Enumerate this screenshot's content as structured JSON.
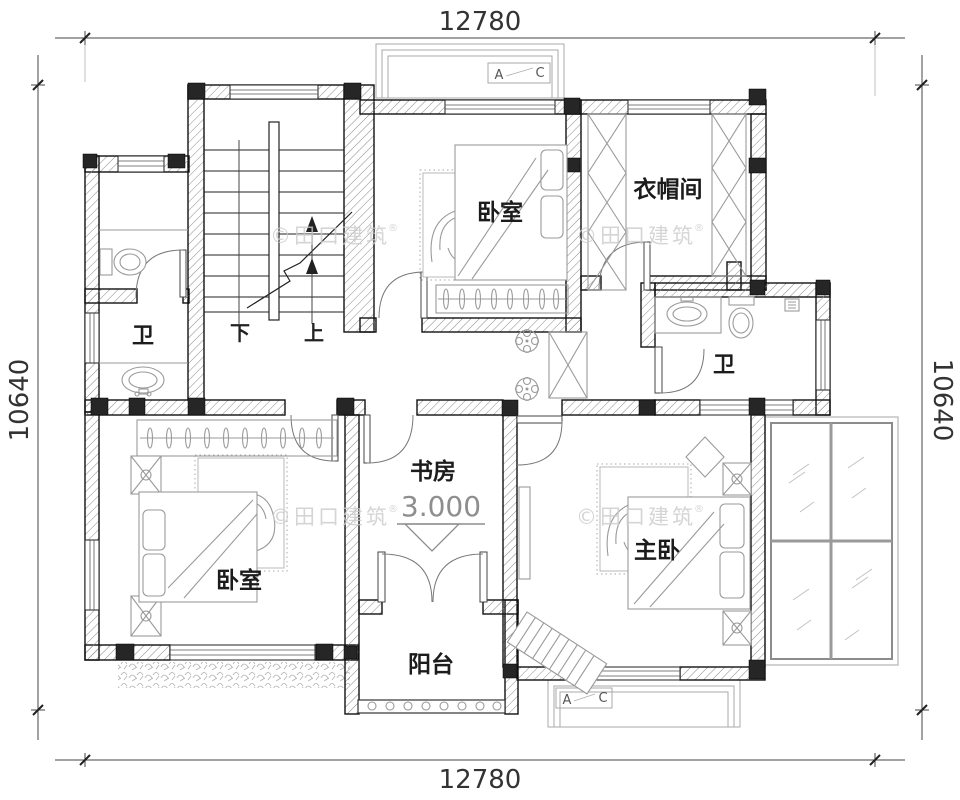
{
  "dimensions": {
    "top": "12780",
    "bottom": "12780",
    "left": "10640",
    "right": "10640"
  },
  "rooms": {
    "bedroom_top": "卧室",
    "cloakroom": "衣帽间",
    "bath_left": "卫",
    "bath_right": "卫",
    "study": "书房",
    "master": "主卧",
    "bedroom_bottom": "卧室",
    "balcony": "阳台"
  },
  "stairs": {
    "down": "下",
    "up": "上"
  },
  "elevation": "3.000",
  "section": {
    "a": "A",
    "c": "C"
  },
  "watermark": {
    "text": "©田口建筑",
    "reg": "®"
  },
  "colors": {
    "wall_line": "#111111",
    "hatch": "#8a8a8a",
    "furniture": "#9a9a9a",
    "dimension_text": "#333333",
    "watermark": "#cbcbcb"
  }
}
